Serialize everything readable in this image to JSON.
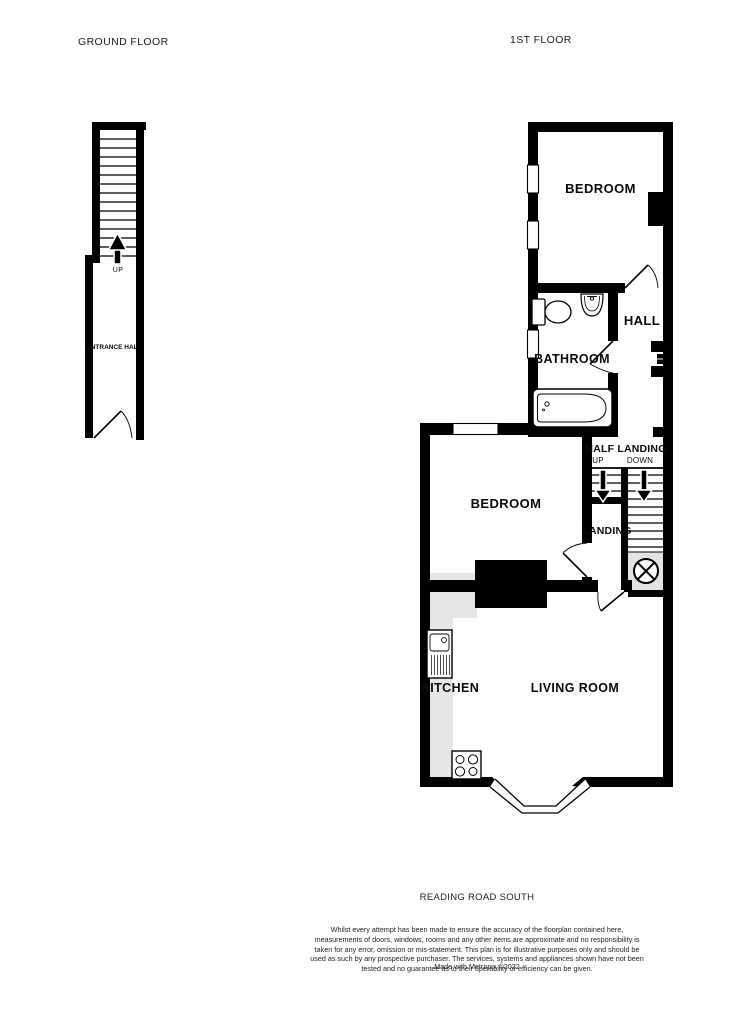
{
  "titles": {
    "ground_floor": "GROUND FLOOR",
    "first_floor": "1ST FLOOR"
  },
  "ground_floor": {
    "entrance_hall": "ENTRANCE HALL",
    "stairs_up": "UP"
  },
  "first_floor": {
    "bedroom_top": "BEDROOM",
    "hall": "HALL",
    "bathroom": "BATHROOM",
    "half_landing": "HALF LANDING",
    "stairs_up": "UP",
    "stairs_down": "DOWN",
    "bedroom_middle": "BEDROOM",
    "landing": "LANDING",
    "kitchen": "KITCHEN",
    "living_room": "LIVING ROOM"
  },
  "footer": {
    "address": "READING ROAD SOUTH",
    "disclaimer": "Whilst every attempt has been made to ensure the accuracy of the floorplan contained here, measurements of doors, windows, rooms and any other items are approximate and no responsibility is taken for any error, omission or mis-statement. This plan is for illustrative purposes only and should be used as such by any prospective purchaser. The services, systems and appliances shown have not been tested and no guarantee as to their operability or efficiency can be given.",
    "credit": "Made with Metropix ©2022"
  },
  "colors": {
    "wall": "#000000",
    "counter": "#e6e6e6",
    "background": "#ffffff"
  }
}
